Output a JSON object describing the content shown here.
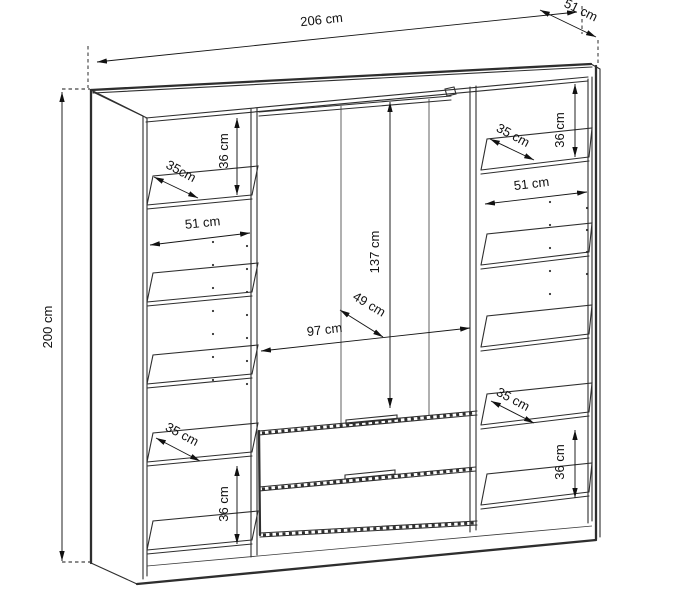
{
  "figure": {
    "type": "furniture-dimension-diagram",
    "subject": "wardrobe interior with shelves, hanging rail and two drawers",
    "units": "cm",
    "line_color": "#2e2e2e",
    "text_color": "#111111",
    "background": "#ffffff"
  },
  "dims": {
    "overall_width": "206 cm",
    "overall_depth": "51 cm",
    "overall_height": "200 cm",
    "left_top_gap": "36 cm",
    "left_top_shelf_depth": "35cm",
    "left_width": "51 cm",
    "left_bottom_shelf_depth": "35 cm",
    "left_bottom_gap": "36 cm",
    "rail_height": "137 cm",
    "rail_depth": "49 cm",
    "center_width": "97 cm",
    "right_top_gap": "36 cm",
    "right_top_shelf_depth": "35 cm",
    "right_width": "51 cm",
    "right_bottom_shelf_depth": "35 cm",
    "right_bottom_gap": "36 cm"
  },
  "measurements": [
    {
      "part": "wardrobe overall",
      "width_cm": 206,
      "depth_cm": 51,
      "height_cm": 200
    },
    {
      "part": "side columns interior",
      "width_cm": 51,
      "shelf_depth_cm": 35,
      "top_compartment_height_cm": 36,
      "bottom_compartment_height_cm": 36
    },
    {
      "part": "center section",
      "width_cm": 97,
      "hanging_height_cm": 137,
      "hanging_depth_cm": 49,
      "drawers": 2
    }
  ]
}
